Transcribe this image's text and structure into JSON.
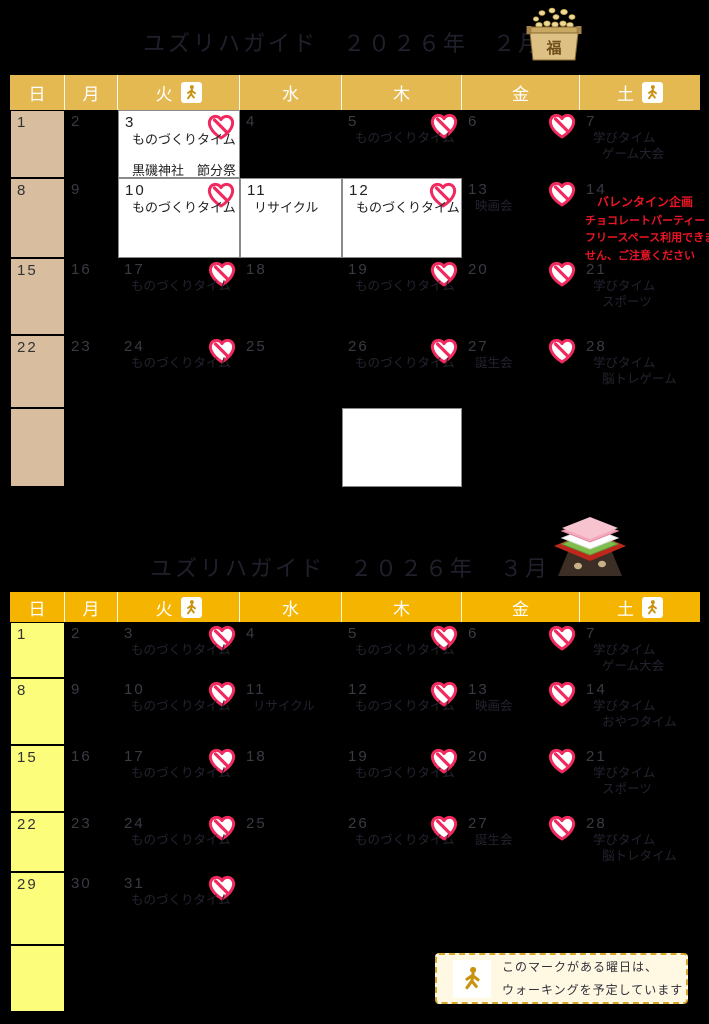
{
  "titles": {
    "feb": "ユズリハガイド　２０２６年　２月",
    "mar": "ユズリハガイド　２０２６年　３月"
  },
  "weekdays": [
    "日",
    "月",
    "火",
    "水",
    "木",
    "金",
    "土"
  ],
  "walk_day_indices": [
    2,
    6
  ],
  "icons": {
    "fuku_label": "福",
    "walk": "walking-person-icon",
    "heart": "heart-sticker-icon",
    "hishimochi": "hishimochi-icon",
    "masu": "setsubun-bean-box-icon"
  },
  "colors": {
    "feb_header": "#E5B952",
    "feb_sunday": "#D8BD9E",
    "mar_header": "#F5B400",
    "mar_sunday": "#FDFD7C",
    "heart_pink": "#F0295F",
    "alert_red": "#EC1525",
    "legend_bg": "#FFF8E2",
    "legend_border": "#D9A62A",
    "walk_gold": "#C8930F"
  },
  "legend": {
    "line1": "このマークがある曜日は、",
    "line2": "ウォーキングを予定しています"
  },
  "calendars": [
    {
      "id": "feb",
      "header_color": "#E5B952",
      "sunday_color": "#D8BD9E",
      "rows": [
        [
          {
            "d": "1",
            "bg": "sun"
          },
          {
            "d": "2"
          },
          {
            "d": "3",
            "bg": "white",
            "heart": true,
            "lines": [
              "ものづくりタイム",
              "",
              "黒磯神社　節分祭"
            ]
          },
          {
            "d": "4"
          },
          {
            "d": "5",
            "heart": true,
            "lines": [
              "ものづくりタイム"
            ]
          },
          {
            "d": "6",
            "heart": true
          },
          {
            "d": "7",
            "lines": [
              "学びタイム",
              "ゲーム大会"
            ]
          }
        ],
        [
          {
            "d": "8",
            "bg": "sun"
          },
          {
            "d": "9"
          },
          {
            "d": "10",
            "bg": "white",
            "heart": true,
            "lines": [
              "ものづくりタイム"
            ]
          },
          {
            "d": "11",
            "bg": "white",
            "lines": [
              "リサイクル"
            ]
          },
          {
            "d": "12",
            "bg": "white",
            "heart": true,
            "lines": [
              "ものづくりタイム"
            ]
          },
          {
            "d": "13",
            "heart": true,
            "lines": [
              "映画会"
            ]
          },
          {
            "d": "14",
            "red": [
              "バレンタイン企画",
              "チョコレートパーティー",
              "フリースペース利用できま",
              "せん、ご注意ください"
            ]
          }
        ],
        [
          {
            "d": "15",
            "bg": "sun"
          },
          {
            "d": "16"
          },
          {
            "d": "17",
            "heart": true,
            "lines": [
              "ものづくりタイム"
            ]
          },
          {
            "d": "18"
          },
          {
            "d": "19",
            "heart": true,
            "lines": [
              "ものづくりタイム"
            ]
          },
          {
            "d": "20",
            "heart": true
          },
          {
            "d": "21",
            "lines": [
              "学びタイム",
              "スポーツ"
            ]
          }
        ],
        [
          {
            "d": "22",
            "bg": "sun"
          },
          {
            "d": "23"
          },
          {
            "d": "24",
            "heart": true,
            "lines": [
              "ものづくりタイム"
            ]
          },
          {
            "d": "25"
          },
          {
            "d": "26",
            "heart": true,
            "lines": [
              "ものづくりタイム"
            ]
          },
          {
            "d": "27",
            "heart": true,
            "lines": [
              "誕生会"
            ]
          },
          {
            "d": "28",
            "lines": [
              "学びタイム",
              "脳トレゲーム"
            ]
          }
        ],
        [
          {
            "bg": "sun"
          },
          {},
          {},
          {},
          {
            "bg": "white"
          },
          {},
          {}
        ]
      ]
    },
    {
      "id": "mar",
      "header_color": "#F5B400",
      "sunday_color": "#FDFD7C",
      "rows": [
        [
          {
            "d": "1",
            "bg": "sun"
          },
          {
            "d": "2"
          },
          {
            "d": "3",
            "heart": true,
            "lines": [
              "ものづくりタイム"
            ]
          },
          {
            "d": "4"
          },
          {
            "d": "5",
            "heart": true,
            "lines": [
              "ものづくりタイム"
            ]
          },
          {
            "d": "6",
            "heart": true
          },
          {
            "d": "7",
            "lines": [
              "学びタイム",
              "ゲーム大会"
            ]
          }
        ],
        [
          {
            "d": "8",
            "bg": "sun"
          },
          {
            "d": "9"
          },
          {
            "d": "10",
            "heart": true,
            "lines": [
              "ものづくりタイム"
            ]
          },
          {
            "d": "11",
            "lines": [
              "リサイクル"
            ]
          },
          {
            "d": "12",
            "heart": true,
            "lines": [
              "ものづくりタイム"
            ]
          },
          {
            "d": "13",
            "heart": true,
            "lines": [
              "映画会"
            ]
          },
          {
            "d": "14",
            "lines": [
              "学びタイム",
              "おやつタイム"
            ]
          }
        ],
        [
          {
            "d": "15",
            "bg": "sun"
          },
          {
            "d": "16"
          },
          {
            "d": "17",
            "heart": true,
            "lines": [
              "ものづくりタイム"
            ]
          },
          {
            "d": "18"
          },
          {
            "d": "19",
            "heart": true,
            "lines": [
              "ものづくりタイム"
            ]
          },
          {
            "d": "20",
            "heart": true
          },
          {
            "d": "21",
            "lines": [
              "学びタイム",
              "スポーツ"
            ]
          }
        ],
        [
          {
            "d": "22",
            "bg": "sun"
          },
          {
            "d": "23"
          },
          {
            "d": "24",
            "heart": true,
            "lines": [
              "ものづくりタイム"
            ]
          },
          {
            "d": "25"
          },
          {
            "d": "26",
            "heart": true,
            "lines": [
              "ものづくりタイム"
            ]
          },
          {
            "d": "27",
            "heart": true,
            "lines": [
              "誕生会"
            ]
          },
          {
            "d": "28",
            "lines": [
              "学びタイム",
              "脳トレタイム"
            ]
          }
        ],
        [
          {
            "d": "29",
            "bg": "sun"
          },
          {
            "d": "30"
          },
          {
            "d": "31",
            "heart": true,
            "lines": [
              "ものづくりタイム"
            ]
          },
          {},
          {},
          {},
          {}
        ],
        [
          {
            "bg": "sun"
          },
          {},
          {},
          {},
          {},
          {},
          {}
        ]
      ]
    }
  ]
}
